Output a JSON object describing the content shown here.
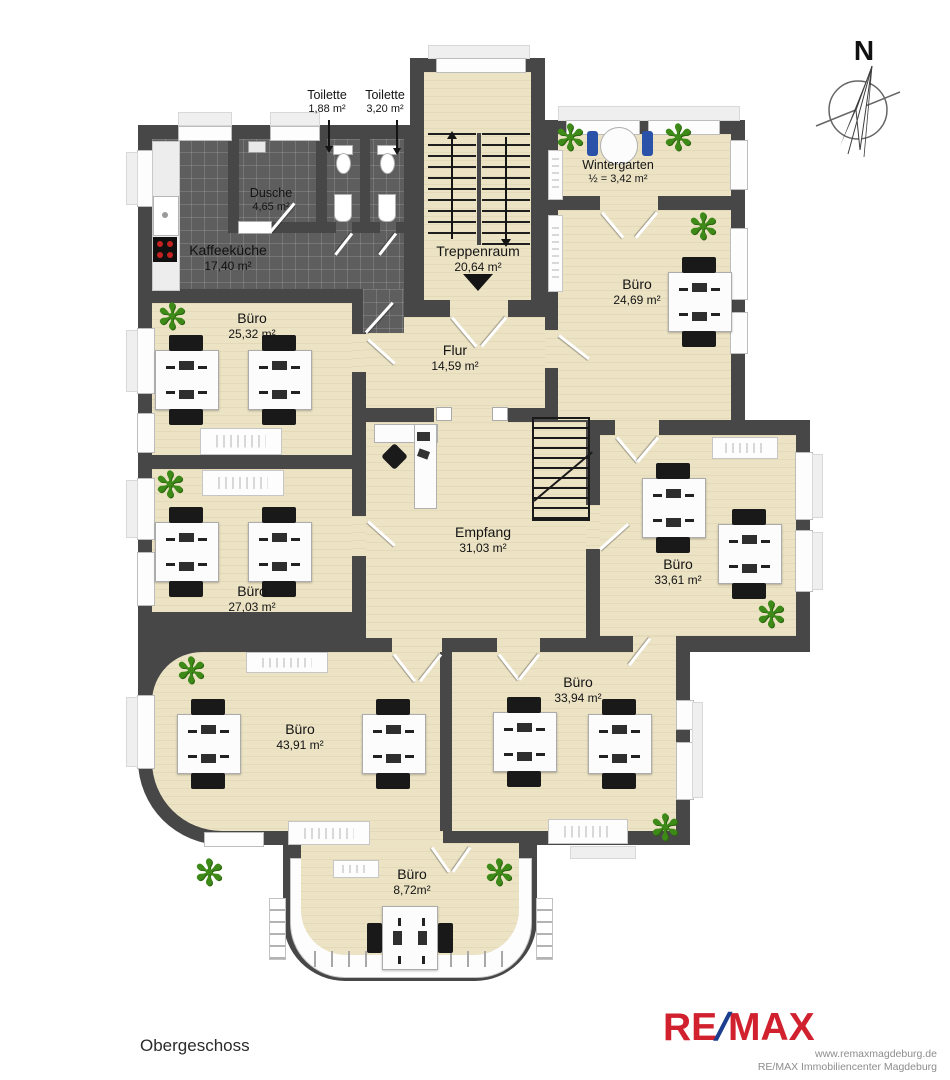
{
  "title": {
    "floor_label": "Obergeschoss"
  },
  "compass": {
    "north_label": "N"
  },
  "rooms": {
    "toilette_small": {
      "name": "Toilette",
      "area": "1,88 m²"
    },
    "toilette_large": {
      "name": "Toilette",
      "area": "3,20 m²"
    },
    "dusche": {
      "name": "Dusche",
      "area": "4,65 m²"
    },
    "kaffeekueche": {
      "name": "Kaffeeküche",
      "area": "17,40 m²"
    },
    "treppenraum": {
      "name": "Treppenraum",
      "area": "20,64 m²"
    },
    "wintergarten": {
      "name": "Wintergarten",
      "area": "½ = 3,42 m²"
    },
    "buero_24_69": {
      "name": "Büro",
      "area": "24,69 m²"
    },
    "buero_25_32": {
      "name": "Büro",
      "area": "25,32 m²"
    },
    "flur": {
      "name": "Flur",
      "area": "14,59 m²"
    },
    "buero_27_03": {
      "name": "Büro",
      "area": "27,03 m²"
    },
    "empfang": {
      "name": "Empfang",
      "area": "31,03 m²"
    },
    "buero_33_61": {
      "name": "Büro",
      "area": "33,61 m²"
    },
    "buero_33_94": {
      "name": "Büro",
      "area": "33,94 m²"
    },
    "buero_43_91": {
      "name": "Büro",
      "area": "43,91 m²"
    },
    "buero_8_72": {
      "name": "Büro",
      "area": "8,72m²"
    }
  },
  "icons": {
    "plant": "✻"
  },
  "branding": {
    "logo_re": "RE",
    "logo_slash": "/",
    "logo_max": "MAX",
    "website": "www.remaxmagdeburg.de",
    "company_line": "RE/MAX Immobiliencenter Magdeburg",
    "logo_red": "#d1202e",
    "logo_blue": "#1d3d8f"
  },
  "colors": {
    "wall": "#474747",
    "wood_floor": "#ece3c5",
    "tile_floor": "#5e5e5e",
    "plant_green": "#3e8a19",
    "window": "#fdfdfd"
  }
}
